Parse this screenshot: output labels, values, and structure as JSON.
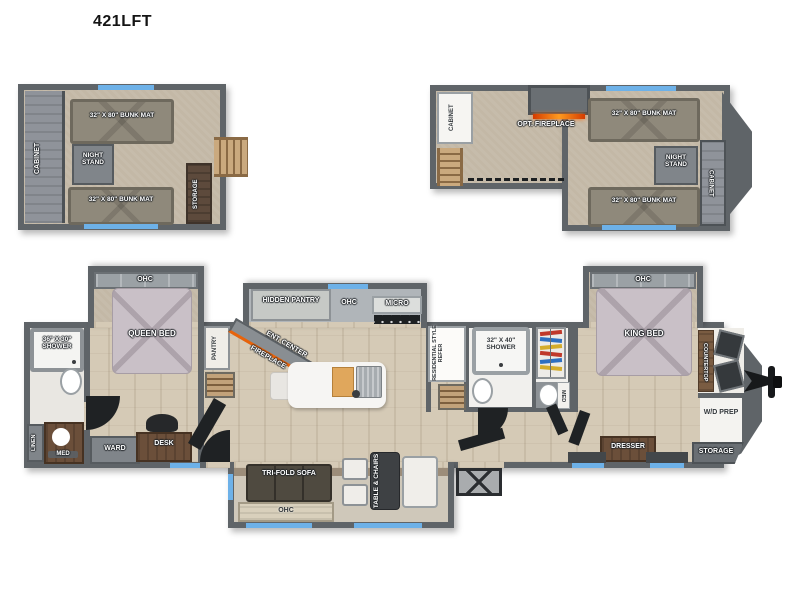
{
  "title": "421LFT",
  "rear_loft": {
    "cabinet": "CABINET",
    "bunk_top": "32\" X 80\" BUNK MAT",
    "night_stand": "NIGHT STAND",
    "bunk_bottom": "32\" X 80\" BUNK MAT",
    "storage": "STORAGE"
  },
  "front_loft": {
    "cabinet_left": "CABINET",
    "opt_fireplace": "OPT. FIREPLACE",
    "bunk_top": "32\" X 80\" BUNK MAT",
    "night_stand": "NIGHT STAND",
    "bunk_bottom": "32\" X 80\" BUNK MAT",
    "cabinet_right": "CABINET"
  },
  "main_floor": {
    "rear_bath": {
      "shower": "36\" X 30\" SHOWER",
      "linen": "LINEN",
      "med": "MED"
    },
    "rear_bedroom": {
      "ohc": "OHC",
      "queen_bed": "QUEEN BED",
      "ward": "WARD",
      "desk": "DESK"
    },
    "kitchen": {
      "pantry": "PANTRY",
      "hidden_pantry": "HIDDEN PANTRY",
      "ohc": "OHC",
      "micro": "MICRO",
      "ent_center": "ENT. CENTER",
      "fireplace": "FIREPLACE"
    },
    "mid_bath": {
      "refer": "RESIDENTIAL STYLE REFER",
      "shower": "32\" X 40\" SHOWER",
      "med": "MED"
    },
    "living": {
      "sofa": "TRI-FOLD SOFA",
      "table_chairs": "TABLE & CHAIRS",
      "ohc": "OHC"
    },
    "front_bedroom": {
      "ohc": "OHC",
      "king_bed": "KING BED",
      "dresser": "DRESSER"
    },
    "front_cap": {
      "countertop": "COUNTERTOP",
      "wd_prep": "W/D PREP",
      "storage": "STORAGE"
    }
  },
  "colors": {
    "wall": "#5f6468",
    "window_accent": "#6db1e8",
    "flame": "#ff7418",
    "bed": "#c9c0c7",
    "bunk": "#8f897b",
    "floor": "#d5cab6",
    "carpet": "#c3b8a6"
  }
}
